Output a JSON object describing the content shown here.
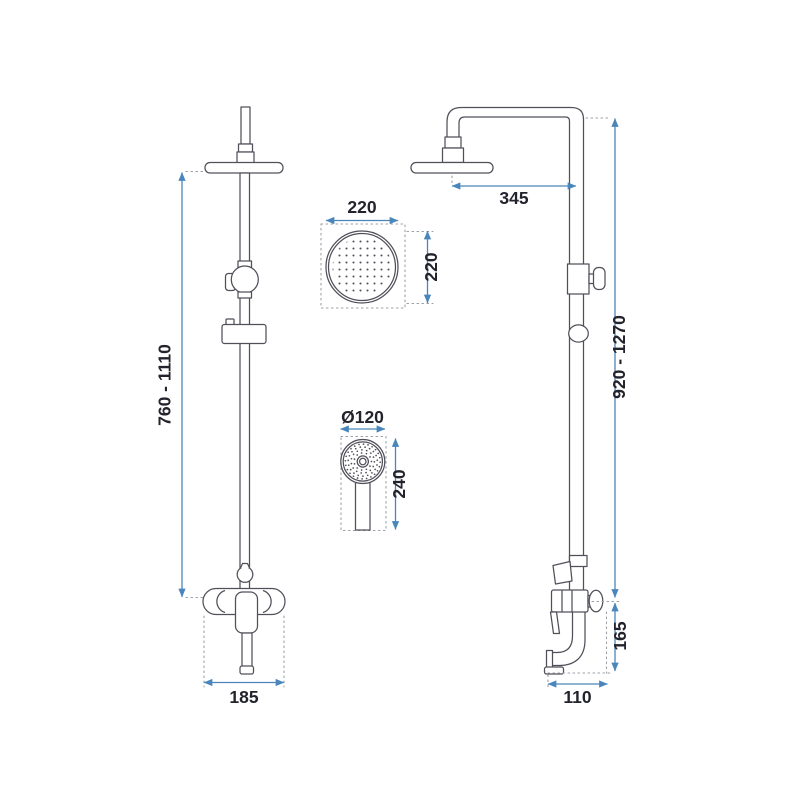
{
  "colors": {
    "dimension": "#4a86bb",
    "drawing": "#50505a",
    "dotted": "#9aa0a6",
    "text": "#23232d",
    "background": "#ffffff"
  },
  "dimensions": {
    "front_height_range": "760 - 1110",
    "front_mixer_width": "185",
    "head_top_view_width": "220",
    "head_top_view_height": "220",
    "hand_shower_diameter": "Ø120",
    "hand_shower_length": "240",
    "head_arm_reach": "345",
    "side_height_range": "920 - 1270",
    "side_spout_drop": "165",
    "side_spout_reach": "110"
  }
}
